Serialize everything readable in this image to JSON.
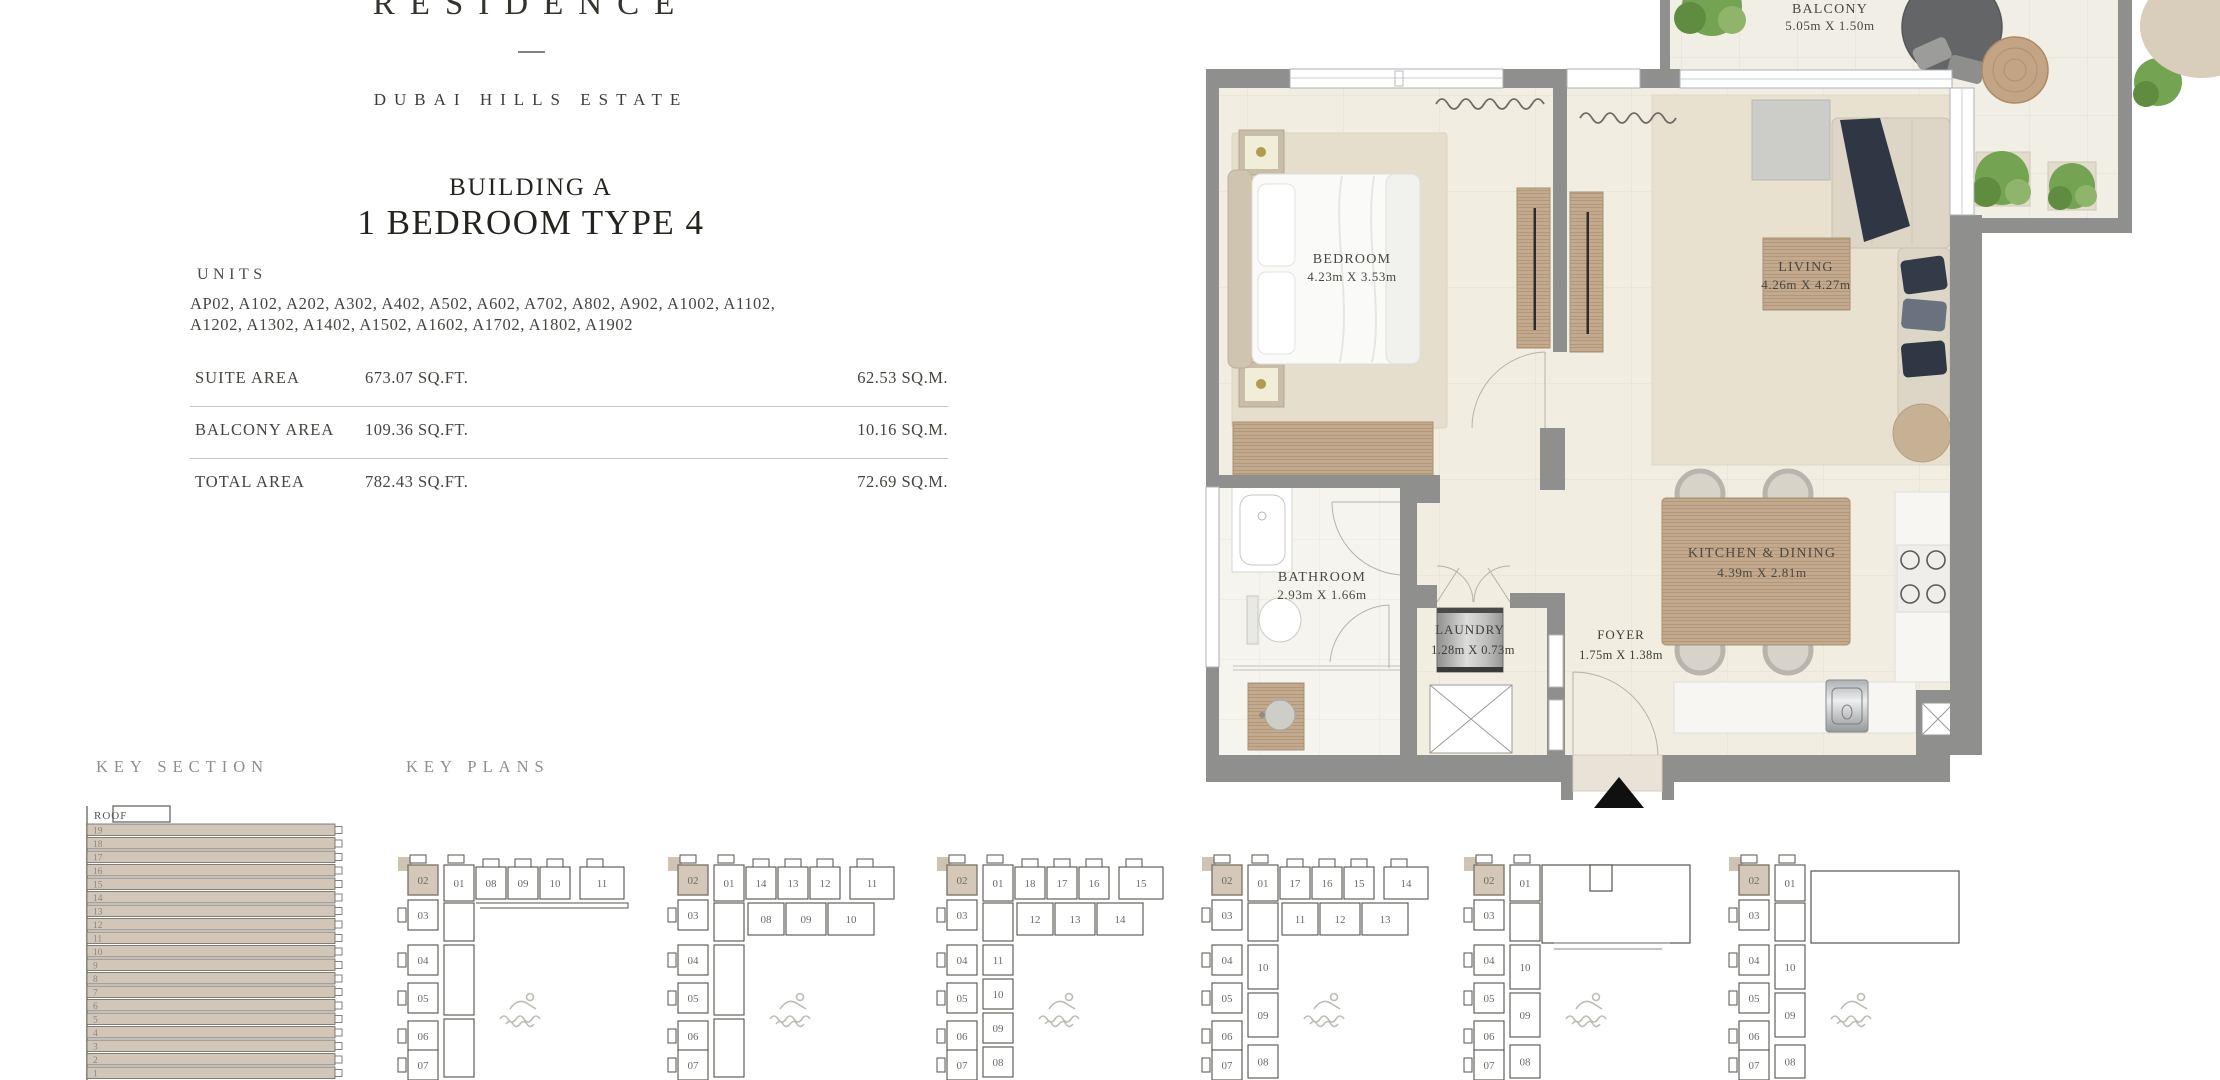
{
  "brand": {
    "name": "RESIDENCE",
    "location": "DUBAI HILLS ESTATE"
  },
  "title": {
    "building": "BUILDING A",
    "unit_type": "1 BEDROOM TYPE 4"
  },
  "units": {
    "heading": "UNITS",
    "line1": "AP02, A102, A202, A302, A402, A502, A602, A702, A802, A902, A1002, A1102,",
    "line2": "A1202, A1302, A1402, A1502, A1602, A1702, A1802, A1902"
  },
  "area_table": {
    "rows": [
      {
        "label": "SUITE AREA",
        "sqft": "673.07 SQ.FT.",
        "sqm": "62.53 SQ.M."
      },
      {
        "label": "BALCONY AREA",
        "sqft": "109.36 SQ.FT.",
        "sqm": "10.16 SQ.M."
      },
      {
        "label": "TOTAL AREA",
        "sqft": "782.43  SQ.FT.",
        "sqm": "72.69 SQ.M."
      }
    ]
  },
  "floor_plan": {
    "rooms": {
      "bedroom": {
        "name": "BEDROOM",
        "dims": "4.23m X 3.53m"
      },
      "living": {
        "name": "LIVING",
        "dims": "4.26m X 4.27m"
      },
      "kitchen_dining": {
        "name": "KITCHEN & DINING",
        "dims": "4.39m X 2.81m"
      },
      "bathroom": {
        "name": "BATHROOM",
        "dims": "2.93m X 1.66m"
      },
      "laundry": {
        "name": "LAUNDRY",
        "dims": "1.28m X 0.73m"
      },
      "foyer": {
        "name": "FOYER",
        "dims": "1.75m X 1.38m"
      },
      "balcony": {
        "name": "BALCONY",
        "dims": "5.05m X 1.50m"
      }
    },
    "entrance_marker_icon": "up-triangle-icon",
    "colors": {
      "wall": "#8f8f8d",
      "floor": "#f1ede1",
      "wood": "#c3aa8e",
      "rug": "#e5decd"
    }
  },
  "key_section": {
    "heading": "KEY SECTION",
    "roof_label": "ROOF",
    "floors": [
      "19",
      "18",
      "17",
      "16",
      "15",
      "14",
      "13",
      "12",
      "11",
      "10",
      "9",
      "8",
      "7",
      "6",
      "5",
      "4",
      "3",
      "2",
      "1"
    ]
  },
  "key_plans": {
    "heading": "KEY PLANS",
    "highlight_unit": "02",
    "highlight_color": "#d5c8b8",
    "plans": [
      {
        "colA": [
          "02",
          "03",
          "04",
          "05",
          "06",
          "07"
        ],
        "colB_top": "01",
        "colB": [],
        "row1": [
          "08",
          "09",
          "10",
          "11"
        ],
        "row2": null,
        "roof": null
      },
      {
        "colA": [
          "02",
          "03",
          "04",
          "05",
          "06",
          "07"
        ],
        "colB_top": "01",
        "colB": [],
        "row1": [
          "14",
          "13",
          "12",
          "11"
        ],
        "row2": [
          "08",
          "09",
          "10"
        ],
        "roof": null
      },
      {
        "colA": [
          "02",
          "03",
          "04",
          "05",
          "06",
          "07"
        ],
        "colB_top": "01",
        "colB": [
          "11",
          "10",
          "09",
          "08"
        ],
        "row1": [
          "18",
          "17",
          "16",
          "15"
        ],
        "row2": [
          "12",
          "13",
          "14"
        ],
        "roof": null
      },
      {
        "colA": [
          "02",
          "03",
          "04",
          "05",
          "06",
          "07"
        ],
        "colB_top": "01",
        "colB": [
          "10",
          "09",
          "08"
        ],
        "row1": [
          "17",
          "16",
          "15",
          "14"
        ],
        "row2": [
          "11",
          "12",
          "13"
        ],
        "roof": null
      },
      {
        "colA": [
          "02",
          "03",
          "04",
          "05",
          "06",
          "07"
        ],
        "colB_top": "01",
        "colB": [
          "10",
          "09",
          "08"
        ],
        "row1": null,
        "row2": null,
        "roof": "notched"
      },
      {
        "colA": [
          "02",
          "03",
          "04",
          "05",
          "06",
          "07"
        ],
        "colB_top": "01",
        "colB": [
          "10",
          "09",
          "08"
        ],
        "row1": null,
        "row2": null,
        "roof": "plain"
      }
    ],
    "pool_icon": "swimmer-icon"
  }
}
